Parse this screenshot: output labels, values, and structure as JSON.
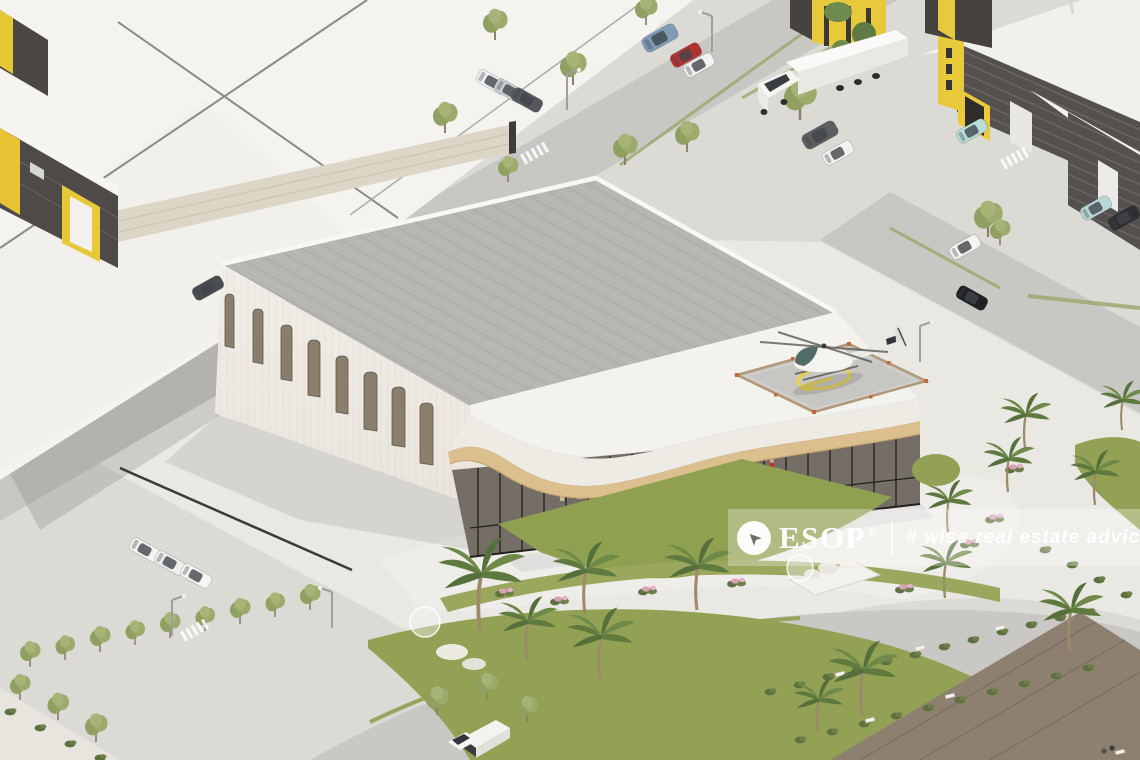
{
  "watermark": {
    "brand": "ESOP",
    "registered_symbol": "®",
    "tagline": "# wise real estate advice",
    "logo_icon": "compass-arrow-icon",
    "band_color": "rgba(255,255,255,0.30)",
    "text_color": "#ffffff"
  },
  "scene": {
    "description": "Aerial 3D architectural rendering of an industrial park: white showroom building with arched windows, rooftop helipad with helicopter, wavy wooden canopy over a glazed entrance, neighbouring warehouses with yellow portals, roads with cars and a truck, palm trees, lawns and pink flower beds",
    "palette": {
      "ground": "#dcdad5",
      "road": "#c8c7c3",
      "main_roof_gray": "#b7b5b2",
      "building_white": "#efece6",
      "canopy_tan": "#dcbf8e",
      "glass_dark": "#756e66",
      "lawn_green": "#93a155",
      "accent_yellow": "#e9c93c",
      "warehouse_dark": "#504c49",
      "helipad_marking_yellow": "#e8d24a",
      "flower_pink": "#d8a0b8"
    }
  }
}
